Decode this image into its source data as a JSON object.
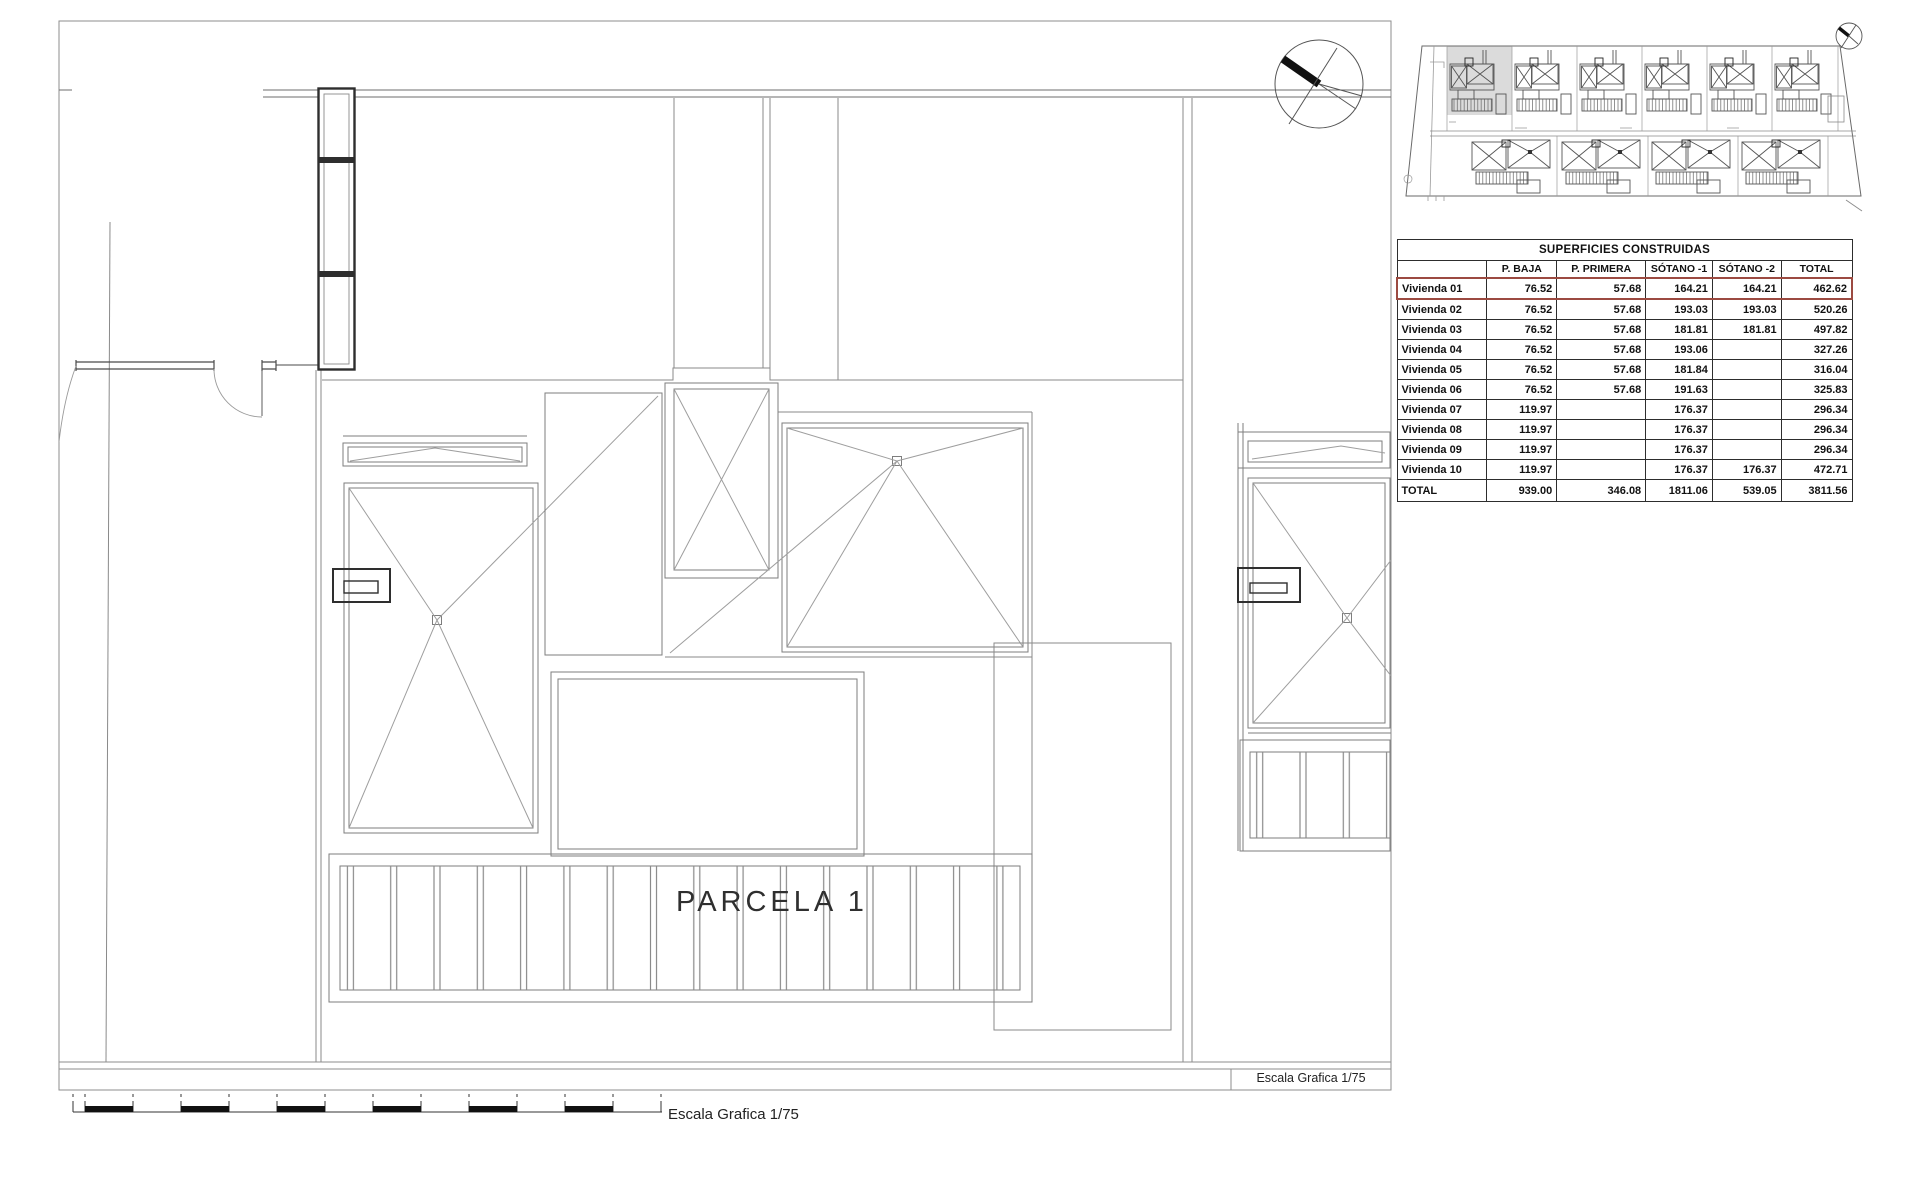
{
  "drawing": {
    "parcel_label": "PARCELA 1",
    "scale_label": "Escala Grafica 1/75",
    "scale_box_label": "Escala Grafica 1/75"
  },
  "colors": {
    "highlight_red": "#9C4A41",
    "selected_parcel_gray": "#DBDBDB"
  },
  "table": {
    "title": "SUPERFICIES CONSTRUIDAS",
    "columns": [
      "P. BAJA",
      "P. PRIMERA",
      "SÓTANO -1",
      "SÓTANO -2",
      "TOTAL"
    ],
    "rows": [
      {
        "label": "Vivienda 01",
        "values": [
          "76.52",
          "57.68",
          "164.21",
          "164.21",
          "462.62"
        ],
        "highlight": true
      },
      {
        "label": "Vivienda 02",
        "values": [
          "76.52",
          "57.68",
          "193.03",
          "193.03",
          "520.26"
        ]
      },
      {
        "label": "Vivienda 03",
        "values": [
          "76.52",
          "57.68",
          "181.81",
          "181.81",
          "497.82"
        ]
      },
      {
        "label": "Vivienda 04",
        "values": [
          "76.52",
          "57.68",
          "193.06",
          "",
          "327.26"
        ]
      },
      {
        "label": "Vivienda 05",
        "values": [
          "76.52",
          "57.68",
          "181.84",
          "",
          "316.04"
        ]
      },
      {
        "label": "Vivienda 06",
        "values": [
          "76.52",
          "57.68",
          "191.63",
          "",
          "325.83"
        ]
      },
      {
        "label": "Vivienda 07",
        "values": [
          "119.97",
          "",
          "176.37",
          "",
          "296.34"
        ]
      },
      {
        "label": "Vivienda 08",
        "values": [
          "119.97",
          "",
          "176.37",
          "",
          "296.34"
        ]
      },
      {
        "label": "Vivienda 09",
        "values": [
          "119.97",
          "",
          "176.37",
          "",
          "296.34"
        ]
      },
      {
        "label": "Vivienda 10",
        "values": [
          "119.97",
          "",
          "176.37",
          "176.37",
          "472.71"
        ]
      },
      {
        "label": "TOTAL",
        "values": [
          "939.00",
          "346.08",
          "1811.06",
          "539.05",
          "3811.56"
        ],
        "is_total": true
      }
    ]
  }
}
